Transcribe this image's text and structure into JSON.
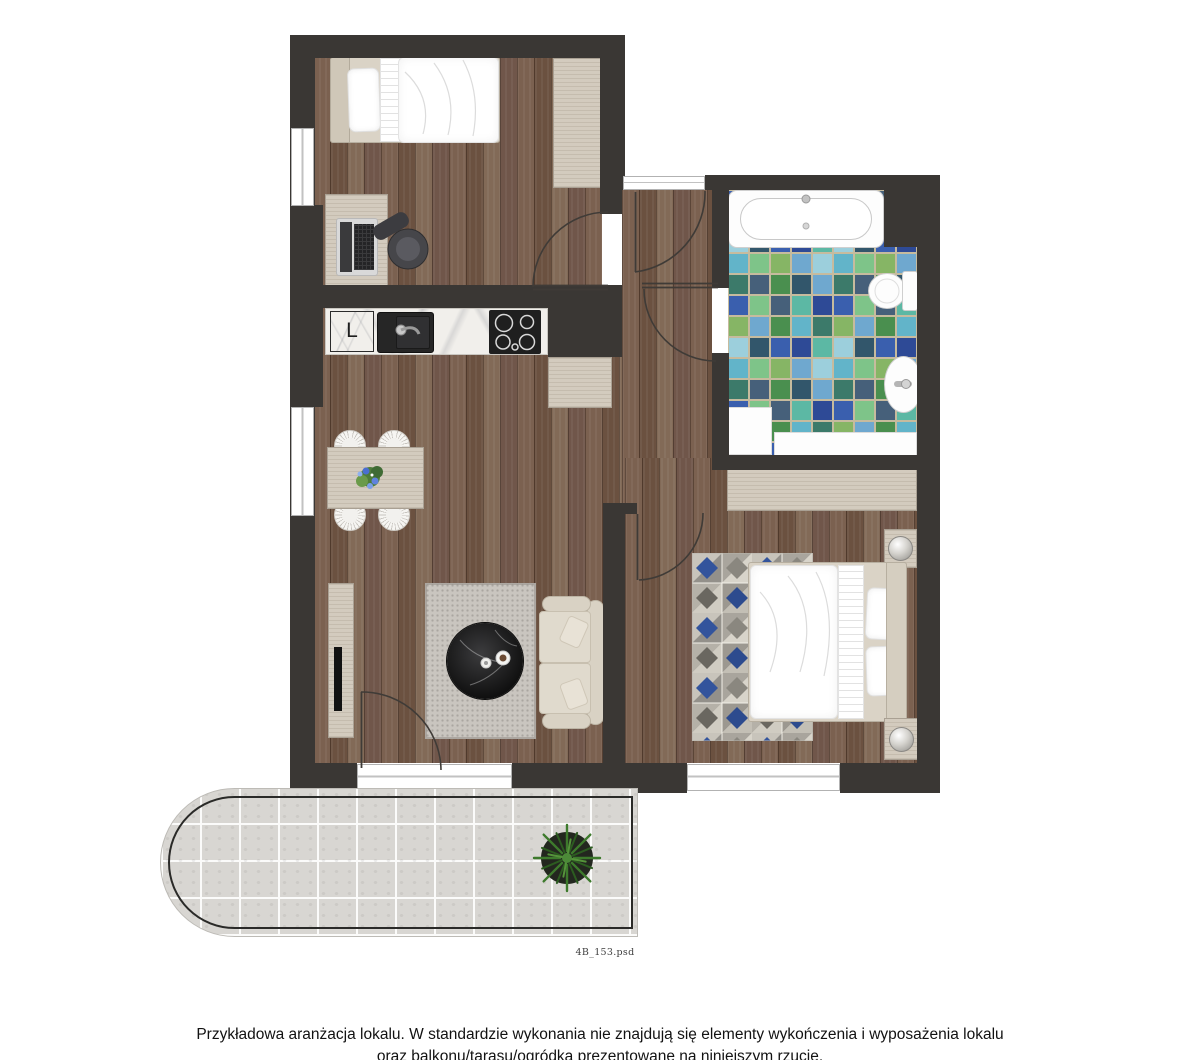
{
  "watermark": "4B_153.psd",
  "caption": {
    "line1": "Przykładowa aranżacja lokalu. W standardzie wykonania nie znajdują się elementy wykończenia i wyposażenia lokalu",
    "line2": "oraz balkonu/tarasu/ogródka prezentowane na niniejszym rzucie."
  },
  "kitchen": {
    "fridge_label": "L"
  },
  "palette": {
    "wall": "#3a3734",
    "wood_a": "#7b6150",
    "wood_b": "#6b5140",
    "wood_c": "#826a57",
    "wood_d": "#70564a",
    "light_wood": "#d3cbbe",
    "marble": "#f1efeb",
    "sofa": "#d9d2c4",
    "rug_living": "#c9c5bf",
    "rug_blue": "#33549c",
    "rug_blue_dark": "#2d4b8e",
    "tile_grout": "#c6bb9e",
    "t1": "#3a5fae",
    "t2": "#6fa8cf",
    "t3": "#5cb8a4",
    "t4": "#3c7a6a",
    "t5": "#7ec489",
    "t6": "#4a8f4f",
    "t7": "#2e4a96",
    "t8": "#9ccfdc",
    "t9": "#46607a",
    "t10": "#62b4c9",
    "t11": "#86b565",
    "t12": "#32566b",
    "balcony_tile": "#d8d6d2",
    "plant_green": "#3d7a2c"
  }
}
